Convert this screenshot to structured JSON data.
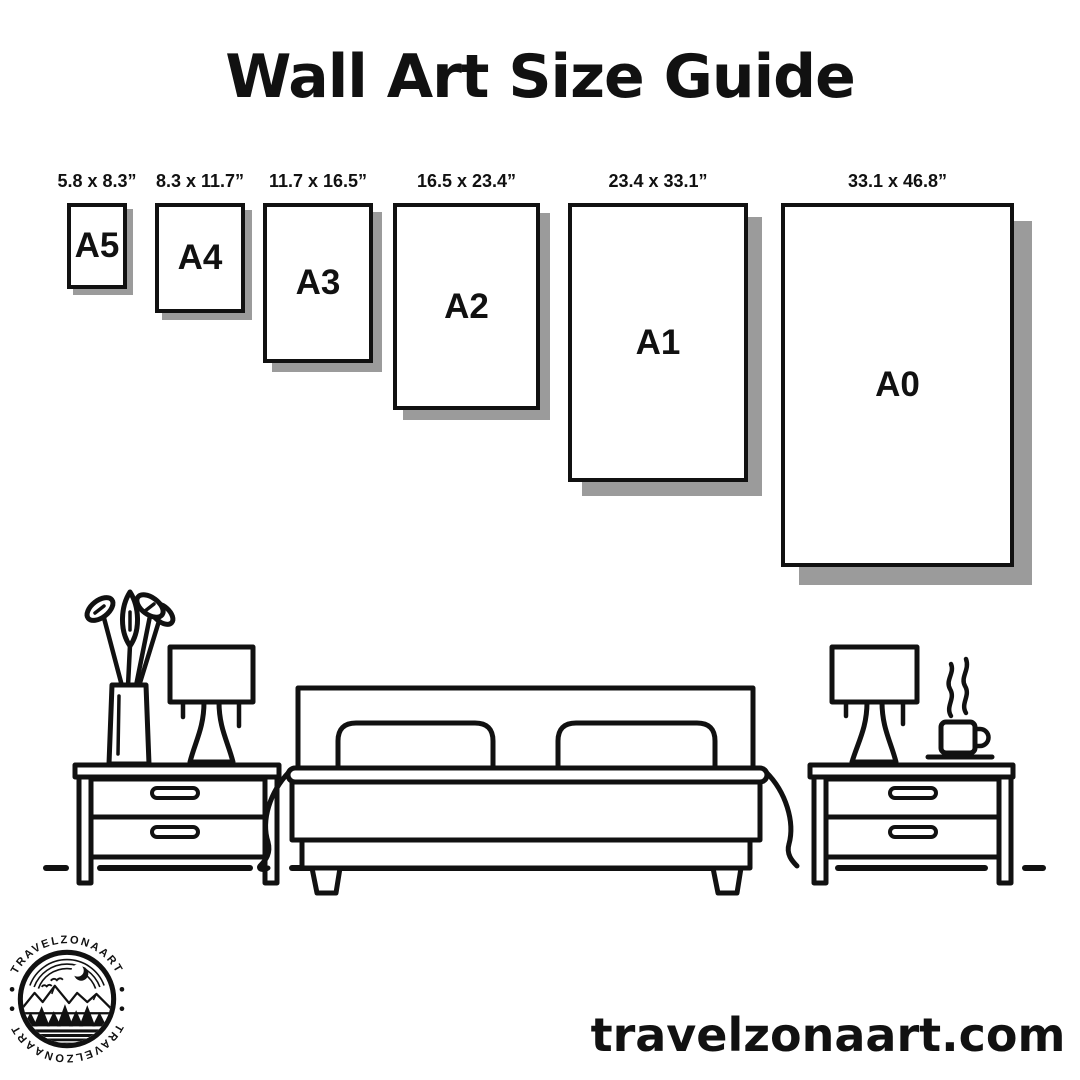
{
  "title": "Wall Art Size Guide",
  "sizes": [
    {
      "label": "A5",
      "dimensions": "5.8 x 8.3”"
    },
    {
      "label": "A4",
      "dimensions": "8.3 x 11.7”"
    },
    {
      "label": "A3",
      "dimensions": "11.7 x 16.5”"
    },
    {
      "label": "A2",
      "dimensions": "16.5 x 23.4”"
    },
    {
      "label": "A1",
      "dimensions": "23.4 x 33.1”"
    },
    {
      "label": "A0",
      "dimensions": "33.1 x 46.8”"
    }
  ],
  "scene": {
    "items": [
      "potted-plant",
      "table-lamp",
      "nightstand",
      "bed-with-two-pillows",
      "nightstand",
      "table-lamp",
      "steaming-coffee-cup",
      "floor-line"
    ]
  },
  "logo": {
    "arc_text_top": "TRAVELZONAART",
    "arc_text_bottom": "TRAVELZONAART"
  },
  "website": "travelzonaart.com",
  "colors": {
    "ink": "#111111",
    "shadow": "#9b9b9b",
    "background": "#ffffff"
  }
}
